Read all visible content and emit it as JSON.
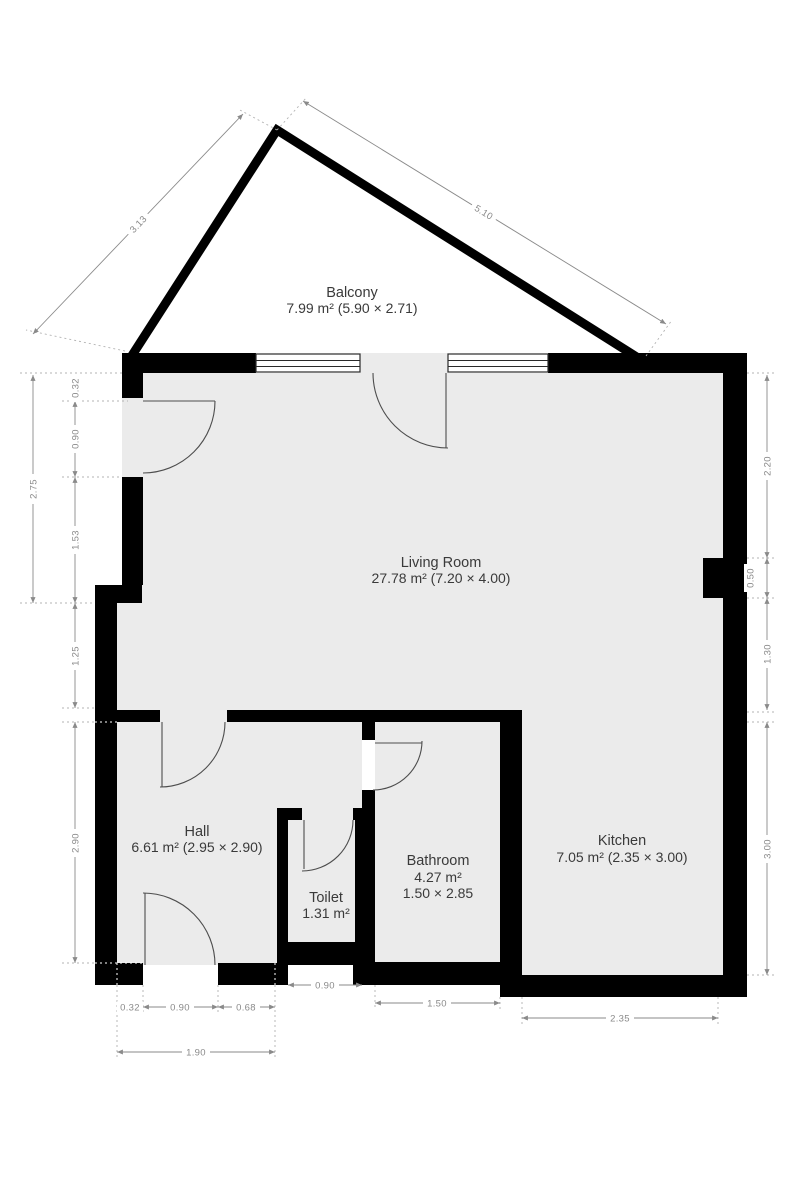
{
  "rooms": {
    "balcony": {
      "name": "Balcony",
      "area": "7.99 m² (5.90 × 2.71)"
    },
    "living": {
      "name": "Living Room",
      "area": "27.78 m² (7.20 × 4.00)"
    },
    "hall": {
      "name": "Hall",
      "area": "6.61 m² (2.95 × 2.90)"
    },
    "toilet": {
      "name": "Toilet",
      "area": "1.31 m²"
    },
    "bathroom": {
      "name": "Bathroom",
      "area": "4.27 m²",
      "dims": "1.50 × 2.85"
    },
    "kitchen": {
      "name": "Kitchen",
      "area": "7.05 m² (2.35 × 3.00)"
    }
  },
  "dims": {
    "balcony_left": "3.13",
    "balcony_right": "5.10",
    "left_total": "2.75",
    "left_a": "0.32",
    "left_b": "0.90",
    "left_c": "1.53",
    "left_d": "1.25",
    "left_e": "2.90",
    "right_a": "2.20",
    "right_b": "0.50",
    "right_c": "1.30",
    "right_d": "3.00",
    "bottom_a": "0.32",
    "bottom_b": "0.90",
    "bottom_c": "0.68",
    "bottom_total": "1.90",
    "bottom_toilet": "0.90",
    "bottom_bathroom": "1.50",
    "bottom_kitchen": "2.35"
  },
  "colors": {
    "wall": "#000000",
    "floor": "#ebebeb",
    "dimension": "#8a8a8a",
    "label": "#3a3a3a",
    "background": "#ffffff"
  }
}
